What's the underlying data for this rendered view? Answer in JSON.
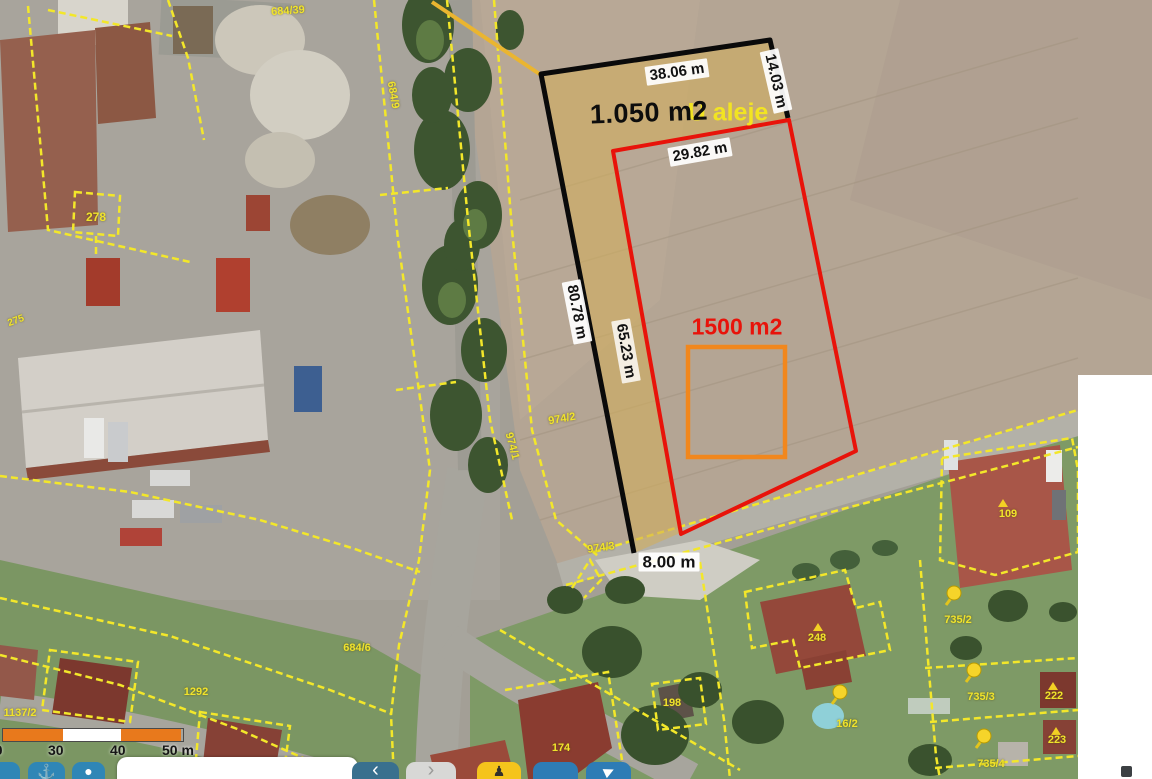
{
  "street_label": "U aleje",
  "areas": {
    "black_plot": "1.050 m2",
    "red_plot": "1500 m2"
  },
  "measurements": {
    "top": "38.06 m",
    "right": "14.03 m",
    "red_top": "29.82 m",
    "left": "80.78 m",
    "inner_left": "65.23 m",
    "bottom": "8.00 m"
  },
  "parcel_numbers": {
    "p684_39": "684/39",
    "p684_9": "684/9",
    "p278": "278",
    "p275": "275",
    "p974_2": "974/2",
    "p974_1": "974/1",
    "p974_3": "974/3",
    "p684_6": "684/6",
    "p1292": "1292",
    "p1137_2": "1137/2",
    "p174": "174",
    "p198": "198",
    "p248": "248",
    "p16_2": "16/2",
    "p735_2": "735/2",
    "p735_3": "735/3",
    "p735_4": "735/4",
    "p109": "109",
    "p222": "222",
    "p223": "223"
  },
  "scalebar": {
    "tick0": "20",
    "tick1": "30",
    "tick2": "40",
    "tick3": "50 m"
  },
  "toolbar": {
    "search_value": "",
    "back_glyph": "‹",
    "forward_glyph": "›",
    "locate_glyph": "⚓",
    "account_glyph": "●",
    "panorama_glyph": "♟",
    "share_glyph": "▶"
  },
  "colors": {
    "cadastral_yellow": "#f3e72a",
    "highlight_fill": "#d3ae5c",
    "plot_black": "#0a0a0a",
    "plot_red": "#e8130a",
    "plot_orange": "#f1871d",
    "scalebar_orange": "#e8791c",
    "toolbar_blue": "#2d7fb0",
    "toolbar_yellow": "#f5c41c"
  }
}
